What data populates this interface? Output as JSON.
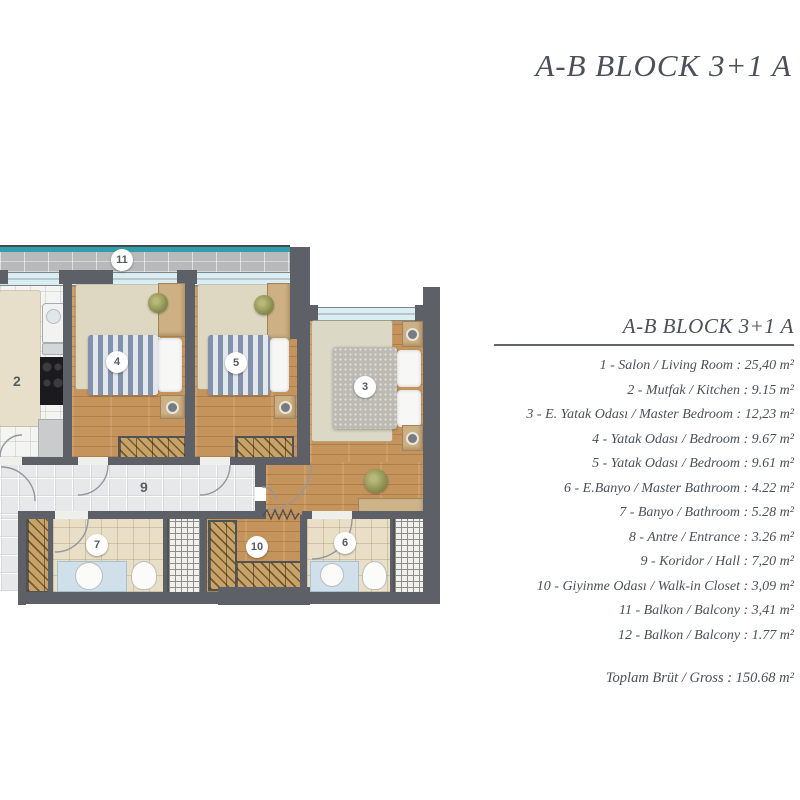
{
  "header": {
    "title": "A-B BLOCK 3+1 A"
  },
  "legend": {
    "title": "A-B BLOCK 3+1 A",
    "items": [
      "1 - Salon / Living Room : 25,40 m²",
      "2 - Mutfak / Kitchen : 9.15 m²",
      "3 - E. Yatak Odası / Master Bedroom : 12,23 m²",
      "4 - Yatak Odası / Bedroom : 9.67 m²",
      "5 - Yatak Odası / Bedroom : 9.61 m²",
      "6 - E.Banyo / Master Bathroom : 4.22 m²",
      "7 - Banyo / Bathroom : 5.28 m²",
      "8 - Antre / Entrance : 3.26 m²",
      "9 - Koridor / Hall : 7,20 m²",
      "10 - Giyinme Odası / Walk-in Closet : 3,09 m²",
      "11 - Balkon / Balcony : 3,41 m²",
      "12 - Balkon / Balcony : 1.77 m²"
    ],
    "total": "Toplam Brüt / Gross : 150.68 m²"
  },
  "plan": {
    "badges": [
      {
        "room": "balcony",
        "label": "11"
      },
      {
        "room": "kitchen",
        "label": "2"
      },
      {
        "room": "bedroom-4",
        "label": "4"
      },
      {
        "room": "bedroom-5",
        "label": "5"
      },
      {
        "room": "master-bedroom",
        "label": "3"
      },
      {
        "room": "hall",
        "label": "9"
      },
      {
        "room": "bathroom",
        "label": "7"
      },
      {
        "room": "walk-in-closet",
        "label": "10"
      },
      {
        "room": "master-bathroom",
        "label": "6"
      }
    ],
    "colors": {
      "wall": "#5d6167",
      "wood_floor": "#c5945c",
      "railing_teal": "#2fa0a9",
      "corridor_tile": "#e7e8ea",
      "bath_tile": "#e9dfc6",
      "fixture_blue": "#cfe0ea",
      "balcony_tile": "#b7b9bb",
      "wardrobe": "#c9a266",
      "text": "#4b505a"
    }
  }
}
